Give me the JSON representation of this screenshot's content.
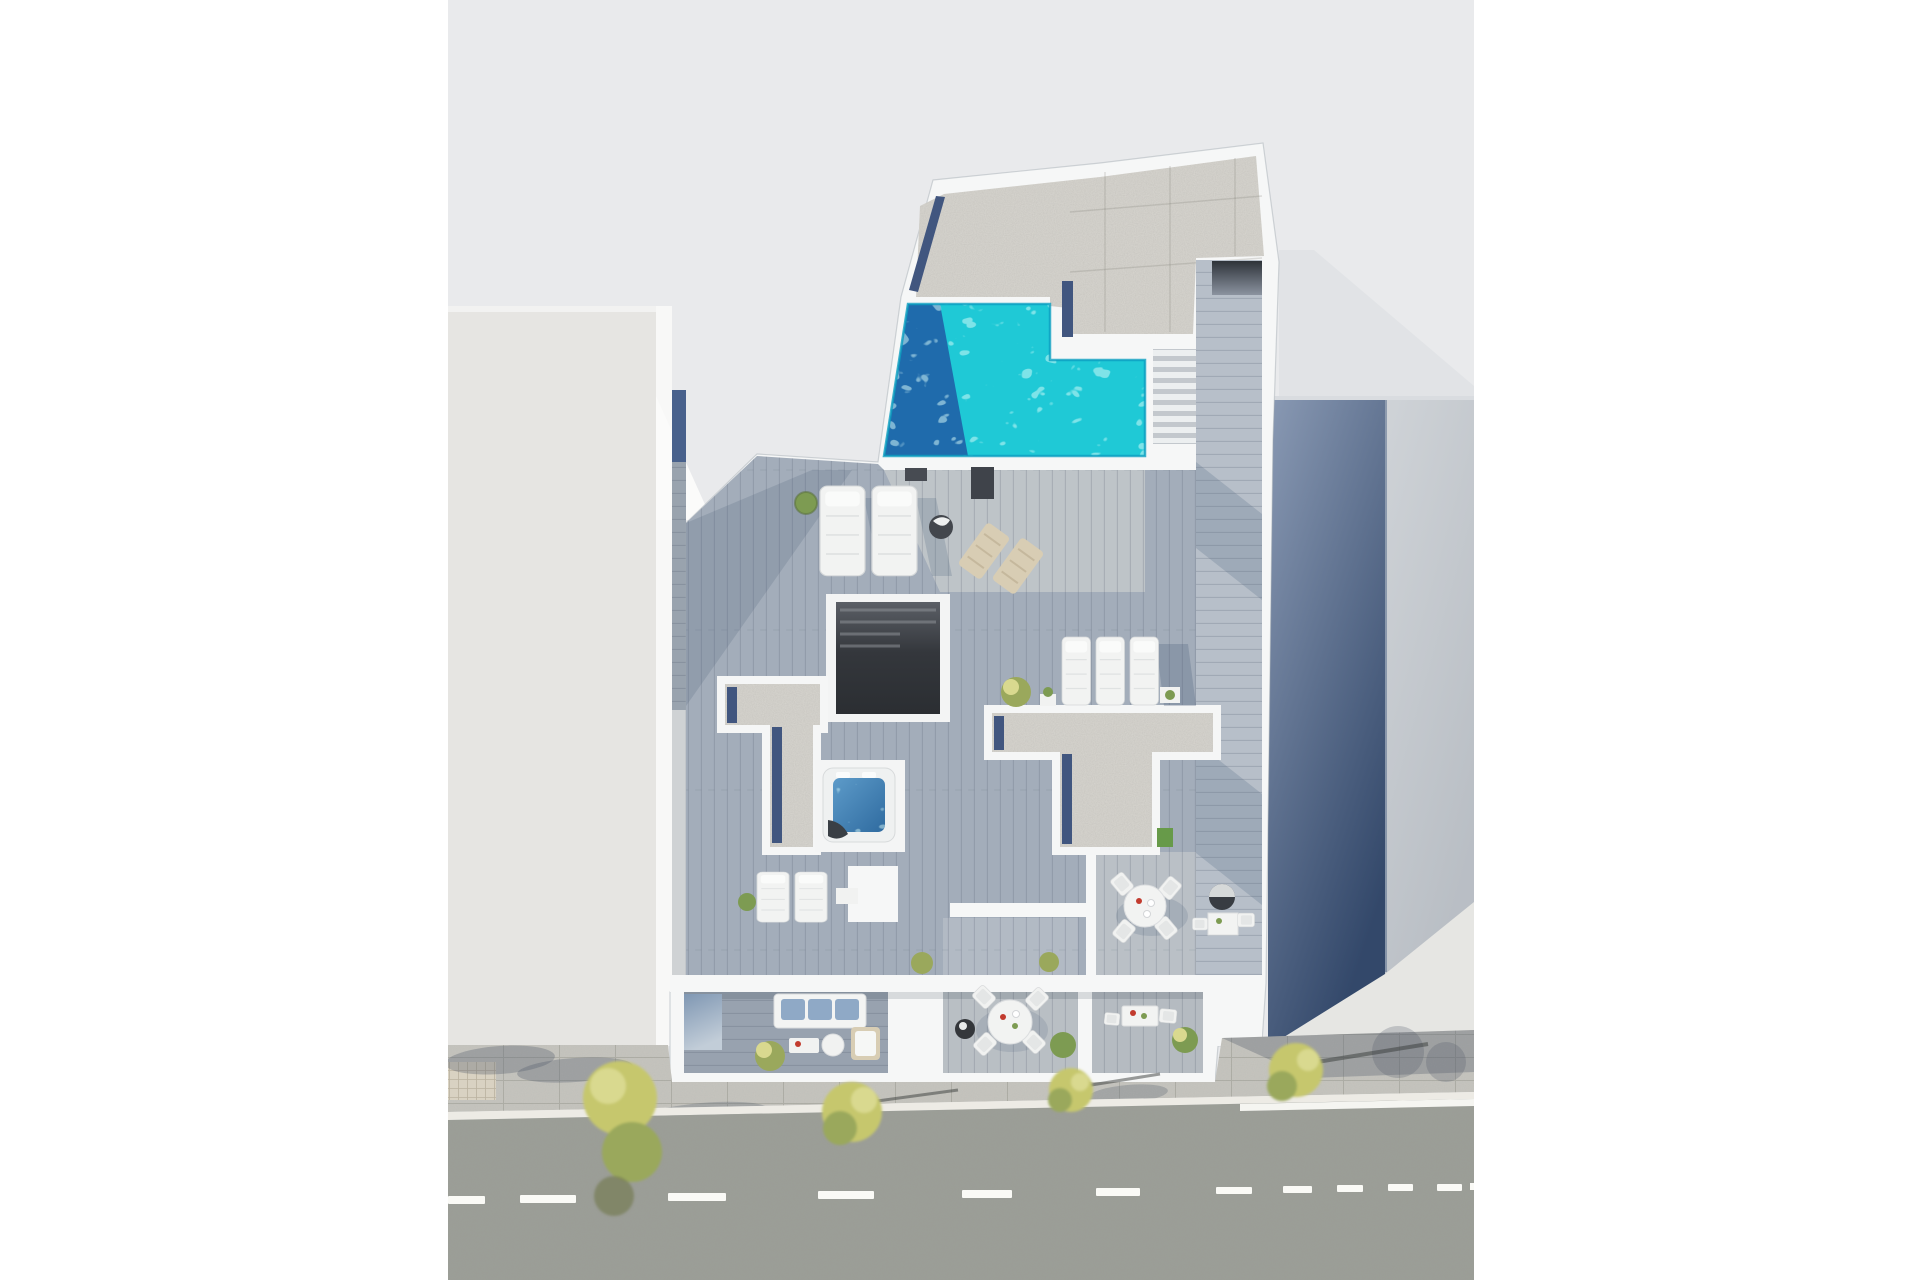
{
  "meta": {
    "title": "Aerial 3D architectural render of an apartment building with rooftop pool",
    "view": "top-down axonometric, sunlit, shadows cast to the lower-right",
    "canvas": {
      "width": 1920,
      "height": 1280,
      "content_left": 448,
      "content_right": 1474
    }
  },
  "scene": {
    "areas": {
      "backdrop": "light gray ground plane",
      "left_building": "neighbouring building, lit light-gray roof face (left)",
      "right_building": "neighbouring building in blue shadow (right)",
      "main_building": "white apartment building, roof level cut-away view",
      "gravel_roof": "speckled gravel flat roof sections",
      "pool": "turquoise rooftop swimming pool with shadowed west edge",
      "stairs": "outdoor staircase beside pool",
      "walkway": "wood deck walkway along right side",
      "stairwell": "dark open stairwell shaft",
      "jacuzzi": "square hot tub with blue water and towel",
      "sun_loungers": "white upholstered sun loungers",
      "dining_set": "round white table with four chairs",
      "bbq": "round barbecue grill",
      "ground_terraces": "three ground-floor terraces: sofa lounge, round dining table, bistro table",
      "sidewalk": "paved sidewalk with yellow-green street trees and cast shadows",
      "street": "asphalt road with dashed white center line and edge line"
    },
    "street": {
      "dash_count": 12,
      "lines": [
        "dashed center line",
        "solid edge line near right sidewalk"
      ]
    },
    "furniture": {
      "pool_terrace": [
        "2 sun loungers",
        "potted plant",
        "folded parasol",
        "2 folding deck chairs",
        "dark mats"
      ],
      "solarium": [
        "3 sun loungers",
        "side tables",
        "small tree planter"
      ],
      "upper_terrace": [
        "2 sun loungers",
        "plant",
        "side table",
        "round dining table + 4 chairs",
        "bbq grill",
        "bistro table + 2 chairs"
      ],
      "ground_floor": [
        "3-seat sofa with blue cushions",
        "coffee tables",
        "rattan lounge chair",
        "round dining table + 4 chairs",
        "dark planter",
        "bistro table + 2 chairs",
        "shrubs"
      ]
    }
  },
  "colors": {
    "margin": "#ffffff",
    "backdrop": "#e9eaec",
    "backdrop_shadow": "#dfe1e5",
    "left_face": "#e6e5e2",
    "left_roof_edge": "#f2f2f1",
    "left_lit_band": "#f8f8f7",
    "right_shadow_top": "#8a9ab4",
    "right_shadow_bottom": "#33486a",
    "right_lit": "#e6e6e3",
    "wall_white": "#f6f7f7",
    "gravel": "#d8d6d0",
    "solar_strip": "#41567f",
    "pool_base": "#1fc9d6",
    "pool_shadow": "#2063a8",
    "pool_rim": "#0d9fc0",
    "deck_shaded": "#a3adba",
    "deck_mid": "#bcc3cb",
    "deck_sun": "#d6d7d4",
    "walk_deck": "#b7bfc9",
    "stairwell_dark": "#34373c",
    "jacuzzi_water": "#4a8cc0",
    "road": "#9b9e97",
    "sidewalk": "#c6c5bf",
    "sidewalk_tile": "#d9d2c2",
    "curb": "#edebe5",
    "marking": "#fafaf6",
    "tree_yellow": "#c6c76d",
    "tree_green": "#9aa85c",
    "tree_light": "#d9d98f",
    "bush_green": "#7d9b52",
    "turf_green": "#679a49",
    "planter_dark": "#34373b",
    "sofa_cushion": "#8fa9c6",
    "furniture_white": "#f2f3f2",
    "furniture_tan": "#d8cdb4",
    "bbq_dark": "#383c42",
    "accent_red": "#c23b2e",
    "glass_top": "#7f97b3",
    "glass_bottom": "#c2cdd8"
  }
}
